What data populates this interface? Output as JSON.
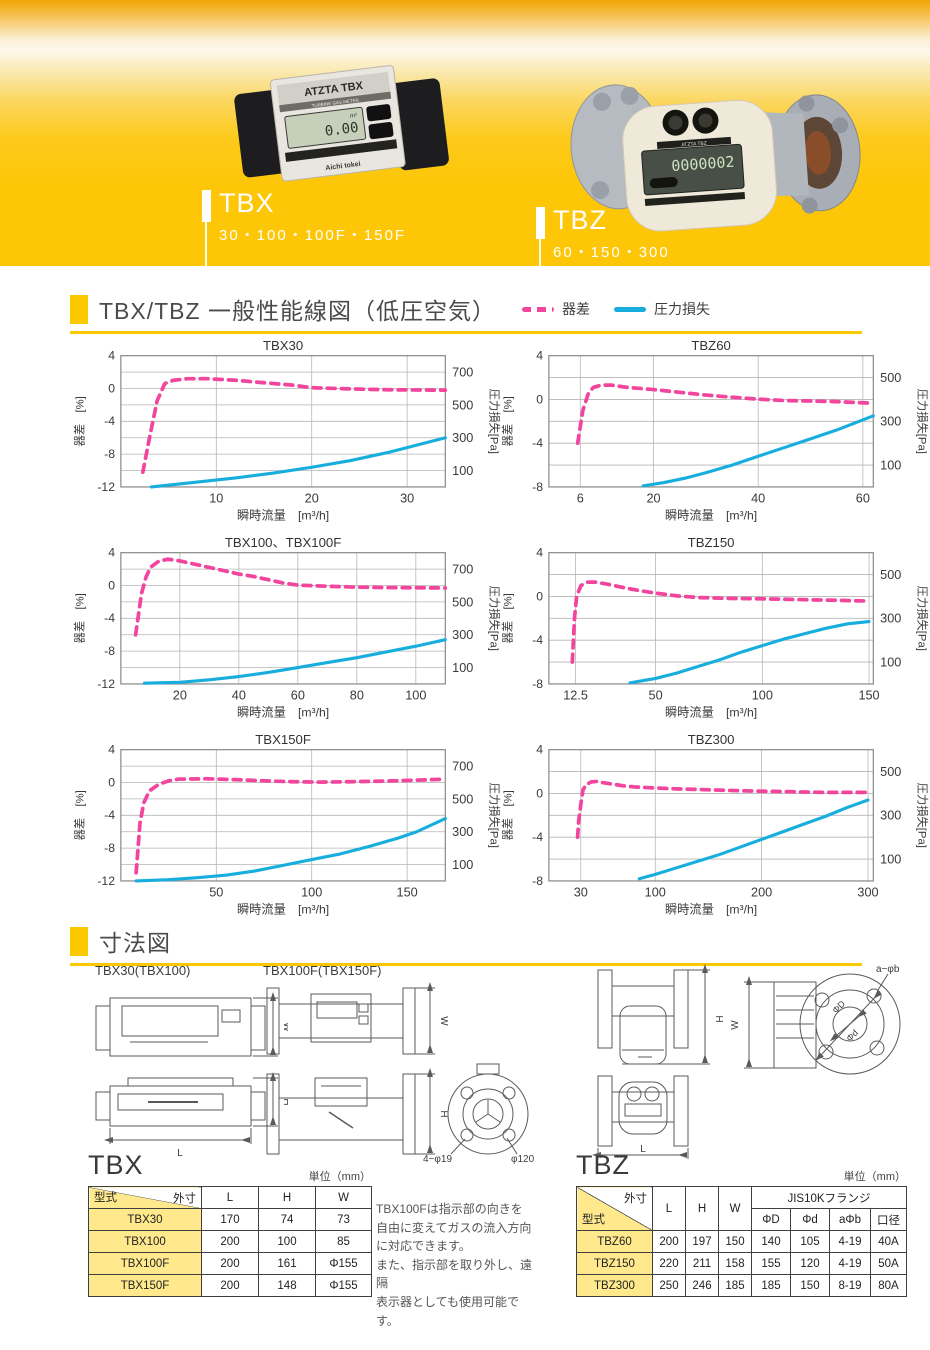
{
  "banner": {
    "products": [
      {
        "code": "TBX",
        "sizes": "30・100・100F・150F",
        "photo_label": "ATZTA TBX",
        "photo_sublabel": "TURBINE GAS METER",
        "lcd": "0.00",
        "lcd_unit": "m³",
        "brand": "Aichi tokei"
      },
      {
        "code": "TBZ",
        "sizes": "60・150・300",
        "photo_label": "ATZTA TBZ",
        "lcd": "0000002"
      }
    ]
  },
  "performance": {
    "title": "TBX/TBZ 一般性能線図（低圧空気）",
    "legend": [
      {
        "label": "器差",
        "color": "#f2459e",
        "style": "dashed"
      },
      {
        "label": "圧力損失",
        "color": "#17aede",
        "style": "solid"
      }
    ]
  },
  "chart_data": [
    {
      "type": "line",
      "title": "TBX30",
      "xlabel": "瞬時流量　[m³/h]",
      "ylabel_left": "器差　[%]",
      "ylabel_right": "圧力損失[Pa]",
      "x_range": [
        0,
        34
      ],
      "x_ticks": [
        10,
        20,
        30
      ],
      "yl_range": [
        -12,
        4
      ],
      "yl_ticks": [
        4,
        0,
        -4,
        -8,
        -12
      ],
      "grid_step": 2,
      "yr_range": [
        0,
        800
      ],
      "yr_labels": [
        700,
        500,
        300,
        100
      ],
      "grid": true,
      "series": [
        {
          "name": "器差",
          "axis": "left",
          "color": "#f2459e",
          "dashed": true,
          "points": [
            [
              2.3,
              -10.2
            ],
            [
              3,
              -6
            ],
            [
              3.8,
              -1.5
            ],
            [
              4.6,
              0.6
            ],
            [
              5.5,
              1.0
            ],
            [
              7,
              1.2
            ],
            [
              9,
              1.2
            ],
            [
              12,
              1.0
            ],
            [
              15,
              0.7
            ],
            [
              18,
              0.4
            ],
            [
              20,
              0.1
            ],
            [
              24,
              -0.05
            ],
            [
              28,
              -0.15
            ],
            [
              34,
              -0.2
            ]
          ]
        },
        {
          "name": "圧力損失",
          "axis": "right",
          "color": "#17aede",
          "dashed": false,
          "points": [
            [
              3.2,
              0
            ],
            [
              8,
              30
            ],
            [
              12,
              55
            ],
            [
              16,
              85
            ],
            [
              20,
              120
            ],
            [
              24,
              160
            ],
            [
              28,
              210
            ],
            [
              31,
              255
            ],
            [
              34,
              300
            ]
          ]
        }
      ]
    },
    {
      "type": "line",
      "title": "TBZ60",
      "xlabel": "瞬時流量　[m³/h]",
      "ylabel_left": "器差　[%]",
      "ylabel_right": "圧力損失[Pa]",
      "x_range": [
        0,
        62
      ],
      "x_ticks": [
        6,
        20,
        40,
        60
      ],
      "yl_range": [
        -8,
        4
      ],
      "yl_ticks": [
        4,
        0,
        -4,
        -8
      ],
      "grid_step": 2,
      "yr_range": [
        0,
        600
      ],
      "yr_labels": [
        500,
        300,
        100
      ],
      "grid": true,
      "series": [
        {
          "name": "器差",
          "axis": "left",
          "color": "#f2459e",
          "dashed": true,
          "points": [
            [
              5.5,
              -4
            ],
            [
              6,
              -2.5
            ],
            [
              6.5,
              -1
            ],
            [
              7.5,
              0.5
            ],
            [
              8.5,
              1.1
            ],
            [
              10,
              1.3
            ],
            [
              12,
              1.3
            ],
            [
              15,
              1.1
            ],
            [
              20,
              0.9
            ],
            [
              25,
              0.65
            ],
            [
              30,
              0.4
            ],
            [
              35,
              0.2
            ],
            [
              40,
              0.02
            ],
            [
              45,
              -0.1
            ],
            [
              50,
              -0.15
            ],
            [
              55,
              -0.2
            ],
            [
              62,
              -0.35
            ]
          ]
        },
        {
          "name": "圧力損失",
          "axis": "right",
          "color": "#17aede",
          "dashed": false,
          "points": [
            [
              18,
              5
            ],
            [
              22,
              20
            ],
            [
              26,
              40
            ],
            [
              30,
              65
            ],
            [
              35,
              100
            ],
            [
              40,
              140
            ],
            [
              45,
              180
            ],
            [
              50,
              220
            ],
            [
              55,
              260
            ],
            [
              62,
              325
            ]
          ]
        }
      ]
    },
    {
      "type": "line",
      "title": "TBX100、TBX100F",
      "xlabel": "瞬時流量　[m³/h]",
      "ylabel_left": "器差　[%]",
      "ylabel_right": "圧力損失[Pa]",
      "x_range": [
        0,
        110
      ],
      "x_ticks": [
        20,
        40,
        60,
        80,
        100
      ],
      "yl_range": [
        -12,
        4
      ],
      "yl_ticks": [
        4,
        0,
        -4,
        -8,
        -12
      ],
      "grid_step": 2,
      "yr_range": [
        0,
        800
      ],
      "yr_labels": [
        700,
        500,
        300,
        100
      ],
      "grid": true,
      "series": [
        {
          "name": "器差",
          "axis": "left",
          "color": "#f2459e",
          "dashed": true,
          "points": [
            [
              5,
              -6
            ],
            [
              6,
              -3.5
            ],
            [
              7,
              -1
            ],
            [
              8.5,
              1
            ],
            [
              10,
              2.2
            ],
            [
              13,
              3.0
            ],
            [
              16,
              3.2
            ],
            [
              20,
              3.0
            ],
            [
              25,
              2.6
            ],
            [
              30,
              2.2
            ],
            [
              35,
              1.8
            ],
            [
              40,
              1.4
            ],
            [
              45,
              1.1
            ],
            [
              50,
              0.7
            ],
            [
              55,
              0.3
            ],
            [
              60,
              0.05
            ],
            [
              70,
              -0.1
            ],
            [
              80,
              -0.2
            ],
            [
              90,
              -0.25
            ],
            [
              110,
              -0.3
            ]
          ]
        },
        {
          "name": "圧力損失",
          "axis": "right",
          "color": "#17aede",
          "dashed": false,
          "points": [
            [
              8,
              5
            ],
            [
              20,
              10
            ],
            [
              30,
              25
            ],
            [
              40,
              45
            ],
            [
              50,
              70
            ],
            [
              60,
              100
            ],
            [
              70,
              130
            ],
            [
              80,
              160
            ],
            [
              90,
              195
            ],
            [
              100,
              230
            ],
            [
              110,
              270
            ]
          ]
        }
      ]
    },
    {
      "type": "line",
      "title": "TBZ150",
      "xlabel": "瞬時流量　[m³/h]",
      "ylabel_left": "器差　[%]",
      "ylabel_right": "圧力損失[Pa]",
      "x_range": [
        0,
        152
      ],
      "x_ticks": [
        12.5,
        50,
        100,
        150
      ],
      "yl_range": [
        -8,
        4
      ],
      "yl_ticks": [
        4,
        0,
        -4,
        -8
      ],
      "grid_step": 2,
      "yr_range": [
        0,
        600
      ],
      "yr_labels": [
        500,
        300,
        100
      ],
      "grid": true,
      "series": [
        {
          "name": "器差",
          "axis": "left",
          "color": "#f2459e",
          "dashed": true,
          "points": [
            [
              11,
              -6
            ],
            [
              11.5,
              -4
            ],
            [
              12,
              -2
            ],
            [
              13,
              0
            ],
            [
              15,
              1
            ],
            [
              18,
              1.3
            ],
            [
              22,
              1.3
            ],
            [
              28,
              1.1
            ],
            [
              35,
              0.8
            ],
            [
              42,
              0.55
            ],
            [
              50,
              0.3
            ],
            [
              60,
              0.05
            ],
            [
              70,
              -0.1
            ],
            [
              85,
              -0.18
            ],
            [
              100,
              -0.22
            ],
            [
              120,
              -0.3
            ],
            [
              135,
              -0.35
            ],
            [
              150,
              -0.42
            ]
          ]
        },
        {
          "name": "圧力損失",
          "axis": "right",
          "color": "#17aede",
          "dashed": false,
          "points": [
            [
              38,
              5
            ],
            [
              50,
              25
            ],
            [
              60,
              50
            ],
            [
              70,
              80
            ],
            [
              80,
              110
            ],
            [
              90,
              145
            ],
            [
              100,
              175
            ],
            [
              110,
              205
            ],
            [
              120,
              230
            ],
            [
              130,
              255
            ],
            [
              140,
              275
            ],
            [
              150,
              285
            ]
          ]
        }
      ]
    },
    {
      "type": "line",
      "title": "TBX150F",
      "xlabel": "瞬時流量　[m³/h]",
      "ylabel_left": "器差　[%]",
      "ylabel_right": "圧力損失[Pa]",
      "x_range": [
        0,
        170
      ],
      "x_ticks": [
        50,
        100,
        150
      ],
      "yl_range": [
        -12,
        4
      ],
      "yl_ticks": [
        4,
        0,
        -4,
        -8,
        -12
      ],
      "grid_step": 2,
      "yr_range": [
        0,
        800
      ],
      "yr_labels": [
        700,
        500,
        300,
        100
      ],
      "grid": true,
      "series": [
        {
          "name": "器差",
          "axis": "left",
          "color": "#f2459e",
          "dashed": true,
          "points": [
            [
              8,
              -11
            ],
            [
              9,
              -8
            ],
            [
              10,
              -5
            ],
            [
              12,
              -2.5
            ],
            [
              15,
              -1
            ],
            [
              20,
              -0.2
            ],
            [
              25,
              0.2
            ],
            [
              30,
              0.4
            ],
            [
              45,
              0.45
            ],
            [
              60,
              0.35
            ],
            [
              75,
              0.2
            ],
            [
              90,
              0.1
            ],
            [
              105,
              0.05
            ],
            [
              120,
              0.1
            ],
            [
              135,
              0.15
            ],
            [
              150,
              0.25
            ],
            [
              170,
              0.4
            ]
          ]
        },
        {
          "name": "圧力損失",
          "axis": "right",
          "color": "#17aede",
          "dashed": false,
          "points": [
            [
              8,
              0
            ],
            [
              25,
              8
            ],
            [
              40,
              20
            ],
            [
              55,
              35
            ],
            [
              70,
              60
            ],
            [
              85,
              95
            ],
            [
              100,
              130
            ],
            [
              115,
              165
            ],
            [
              130,
              210
            ],
            [
              145,
              260
            ],
            [
              155,
              300
            ],
            [
              170,
              380
            ]
          ]
        }
      ]
    },
    {
      "type": "line",
      "title": "TBZ300",
      "xlabel": "瞬時流量　[m³/h]",
      "ylabel_left": "器差　[%]",
      "ylabel_right": "圧力損失[Pa]",
      "x_range": [
        0,
        305
      ],
      "x_ticks": [
        30,
        100,
        200,
        300
      ],
      "yl_range": [
        -8,
        4
      ],
      "yl_ticks": [
        4,
        0,
        -4,
        -8
      ],
      "grid_step": 2,
      "yr_range": [
        0,
        600
      ],
      "yr_labels": [
        500,
        300,
        100
      ],
      "grid": true,
      "series": [
        {
          "name": "器差",
          "axis": "left",
          "color": "#f2459e",
          "dashed": true,
          "points": [
            [
              27,
              -4
            ],
            [
              28,
              -2.5
            ],
            [
              30,
              -1
            ],
            [
              32,
              0.3
            ],
            [
              35,
              0.8
            ],
            [
              40,
              1.05
            ],
            [
              45,
              1.1
            ],
            [
              50,
              1.0
            ],
            [
              60,
              0.85
            ],
            [
              70,
              0.7
            ],
            [
              80,
              0.6
            ],
            [
              100,
              0.5
            ],
            [
              120,
              0.42
            ],
            [
              140,
              0.36
            ],
            [
              160,
              0.3
            ],
            [
              180,
              0.25
            ],
            [
              200,
              0.2
            ],
            [
              230,
              0.15
            ],
            [
              260,
              0.1
            ],
            [
              300,
              0.1
            ]
          ]
        },
        {
          "name": "圧力損失",
          "axis": "right",
          "color": "#17aede",
          "dashed": false,
          "points": [
            [
              85,
              10
            ],
            [
              100,
              30
            ],
            [
              120,
              60
            ],
            [
              140,
              90
            ],
            [
              160,
              120
            ],
            [
              180,
              155
            ],
            [
              200,
              190
            ],
            [
              220,
              225
            ],
            [
              240,
              260
            ],
            [
              260,
              295
            ],
            [
              280,
              335
            ],
            [
              300,
              370
            ]
          ]
        }
      ]
    }
  ],
  "dimensions": {
    "section_title": "寸法図",
    "drawing_labels": [
      "TBX30(TBX100)",
      "TBX100F(TBX150F)"
    ],
    "dim_labels": {
      "W": "W",
      "H": "H",
      "L": "L",
      "four_phi19": "4−φ19",
      "phi120": "φ120",
      "a_phi_b": "a−φb",
      "phiD": "ΦD",
      "phid": "Φd"
    }
  },
  "tbx_table": {
    "title": "TBX",
    "unit": "単位（mm）",
    "corner_top": "外寸",
    "corner_bottom": "型式",
    "columns": [
      "L",
      "H",
      "W"
    ],
    "rows": [
      {
        "model": "TBX30",
        "values": [
          "170",
          "74",
          "73"
        ]
      },
      {
        "model": "TBX100",
        "values": [
          "200",
          "100",
          "85"
        ]
      },
      {
        "model": "TBX100F",
        "values": [
          "200",
          "161",
          "Φ155"
        ]
      },
      {
        "model": "TBX150F",
        "values": [
          "200",
          "148",
          "Φ155"
        ]
      }
    ]
  },
  "tbx_note": "TBX100Fは指示部の向きを\n自由に変えてガスの流入方向\nに対応できます。\nまた、指示部を取り外し、遠隔\n表示器としても使用可能です。",
  "tbz_table": {
    "title": "TBZ",
    "unit": "単位（mm）",
    "corner_top": "外寸",
    "corner_bottom": "型式",
    "columns": [
      "L",
      "H",
      "W"
    ],
    "flange_group": "JIS10Kフランジ",
    "flange_columns": [
      "ΦD",
      "Φd",
      "aΦb",
      "口径"
    ],
    "rows": [
      {
        "model": "TBZ60",
        "values": [
          "200",
          "197",
          "150",
          "140",
          "105",
          "4-19",
          "40A"
        ]
      },
      {
        "model": "TBZ150",
        "values": [
          "220",
          "211",
          "158",
          "155",
          "120",
          "4-19",
          "50A"
        ]
      },
      {
        "model": "TBZ300",
        "values": [
          "250",
          "246",
          "185",
          "185",
          "150",
          "8-19",
          "80A"
        ]
      }
    ]
  }
}
